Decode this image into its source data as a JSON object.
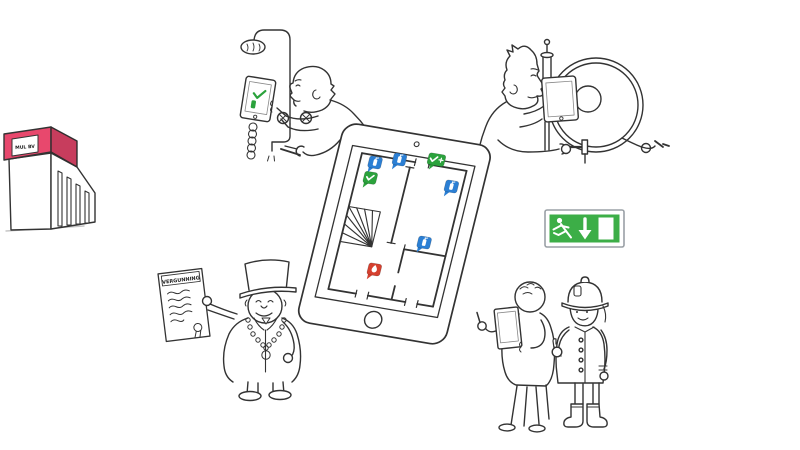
{
  "illustration": {
    "background": "#ffffff",
    "line_color": "#333333"
  },
  "building": {
    "sign_label": "MUL BV",
    "accent_color": "#e8486d"
  },
  "permit": {
    "title": "VERGUNNING"
  },
  "exit_sign": {
    "green": "#3cae47",
    "icons": [
      "running-man-icon",
      "down-arrow-icon",
      "door-icon"
    ]
  },
  "inspector_tablet": {
    "check_color": "#2ba23c"
  },
  "floorplan": {
    "marker_colors": {
      "default": "#2b7fd4",
      "ok": "#2ba23c",
      "alert": "#d5402f"
    },
    "markers": [
      {
        "icon": "extinguisher-icon",
        "status": "default",
        "x": 39,
        "y": 37
      },
      {
        "icon": "check-icon",
        "status": "ok",
        "x": 38,
        "y": 53
      },
      {
        "icon": "extinguisher-icon",
        "status": "default",
        "x": 62,
        "y": 30
      },
      {
        "icon": "check-plus-icon",
        "status": "ok",
        "x": 98,
        "y": 24,
        "wide": true
      },
      {
        "icon": "extinguisher-icon",
        "status": "default",
        "x": 119,
        "y": 48
      },
      {
        "icon": "extinguisher-icon",
        "status": "default",
        "x": 106,
        "y": 108
      },
      {
        "icon": "flame-icon",
        "status": "alert",
        "x": 64,
        "y": 143
      }
    ]
  }
}
